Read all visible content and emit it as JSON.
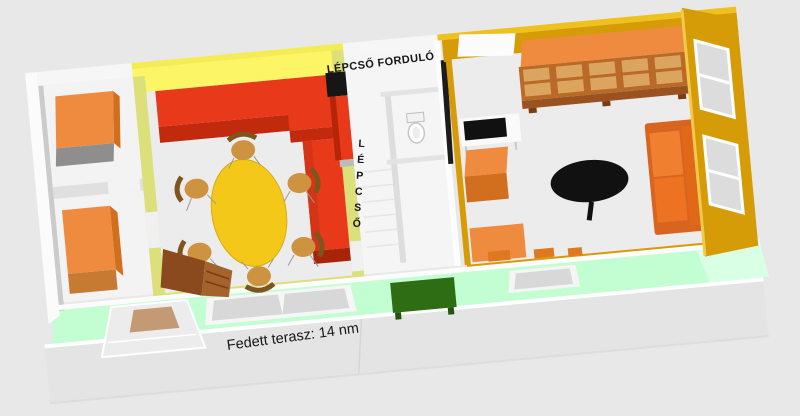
{
  "labels": {
    "stair_landing": "LÉPCSŐ FORDULÓ",
    "stairs": "LÉPCSŐ",
    "terrace": "Fedett terasz: 14 nm"
  },
  "colors": {
    "background": "#e8e8e8",
    "terrace_slab": "#e4e4e4",
    "mint_wall": "#c3fed3",
    "floor": "#ececec",
    "white_wall": "#f9f9f9",
    "gray_wall_shadow": "#cbcbcb",
    "olive_wall": "#dce07b",
    "yellow_wall": "#fcf566",
    "yellow_wall_rim": "#f4ec52",
    "gold_wall": "#d69c07",
    "gold_wall_rim": "#eec11c",
    "sofa_red": "#e8391b",
    "sofa_red_dark": "#c22a0e",
    "furniture_orange": "#ef8b3e",
    "furniture_orange_dark": "#d26f1f",
    "cabinet_brown": "#b96a28",
    "cabinet_pane": "#dca55f",
    "shelf_brown": "#8a4a1d",
    "table_yellow": "#f4c818",
    "chair_tan": "#cd9340",
    "chair_back_brown": "#7e551f",
    "table_black": "#111111",
    "bench_green": "#2f6d15",
    "glass_gray": "#d8d8d8",
    "door_mat_tan": "#c39a74"
  },
  "scene_objects": {
    "left_wardrobe_top": "orange wardrobe",
    "left_wardrobe_bottom": "orange wardrobe",
    "living_sofa": "red corner sofa",
    "dining_table": "yellow oval table with 6 chairs",
    "fireplace": "red fireplace with black flue",
    "bathroom_fixture": "toilet",
    "kitchen_counter": "white counter with black cooktop",
    "display_cabinet": "orange glass-front cabinet",
    "coffee_table": "black oval table",
    "right_sofa": "orange sofa",
    "terrace_bench": "dark green bench",
    "terrace_doors": "glass terrace doors",
    "entrance_steps": "entrance steps with mat"
  }
}
